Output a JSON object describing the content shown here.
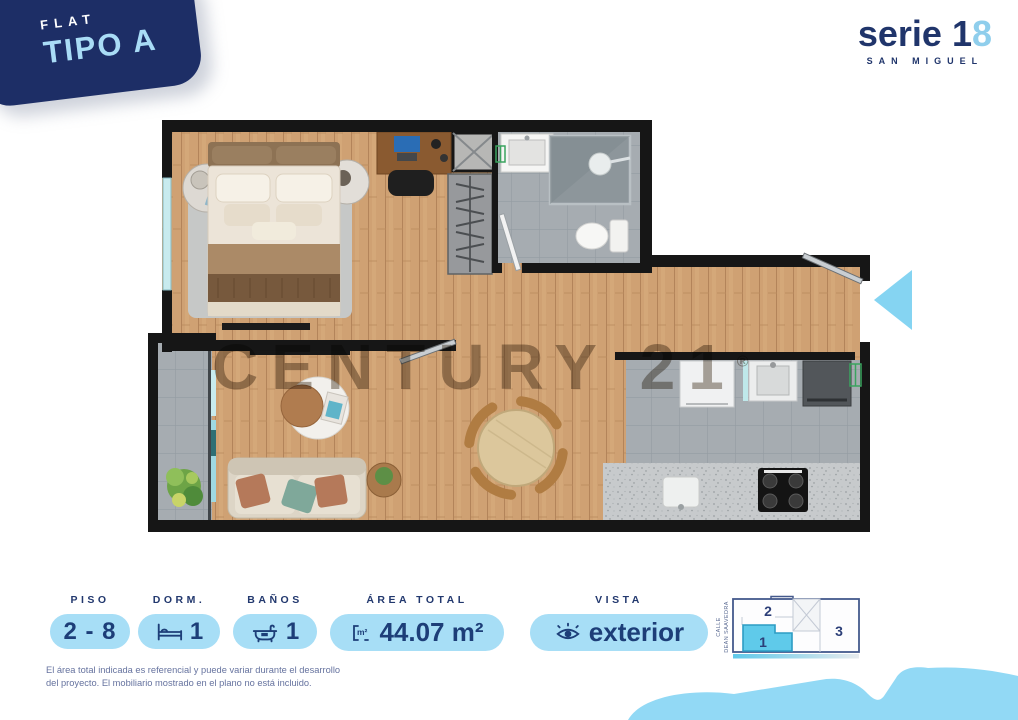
{
  "badge": {
    "category": "FLAT",
    "type_name": "TIPO A"
  },
  "logo": {
    "brand": "serie",
    "num": "1",
    "accent": "8",
    "location": "SAN MIGUEL"
  },
  "floorplan": {
    "watermark": "CENTURY 21",
    "registered_mark": "®"
  },
  "specs": {
    "piso": {
      "label": "PISO",
      "value": "2 - 8"
    },
    "dorm": {
      "label": "DORM.",
      "value": "1",
      "icon": "bed-icon"
    },
    "banos": {
      "label": "BAÑOS",
      "value": "1",
      "icon": "bathtub-icon"
    },
    "area": {
      "label": "ÁREA TOTAL",
      "value": "44.07 m²",
      "icon": "m2-icon",
      "icon_label": "m²"
    },
    "vista": {
      "label": "VISTA",
      "value": "exterior",
      "icon": "eye-icon"
    }
  },
  "key_plan": {
    "street_line1": "CALLE",
    "street_line2": "DEAN SAAVEDRA",
    "unit_top": "2",
    "unit_highlighted": "1",
    "unit_right": "3"
  },
  "disclaimer": "El área total indicada es referencial y puede variar durante el desarrollo del proyecto. El mobiliario mostrado en el plano no está incluido.",
  "colors": {
    "navy": "#1d2e66",
    "pill_blue": "#a7def6",
    "highlight_cyan": "#5fcaea",
    "wave_blue": "#92d9f5"
  }
}
